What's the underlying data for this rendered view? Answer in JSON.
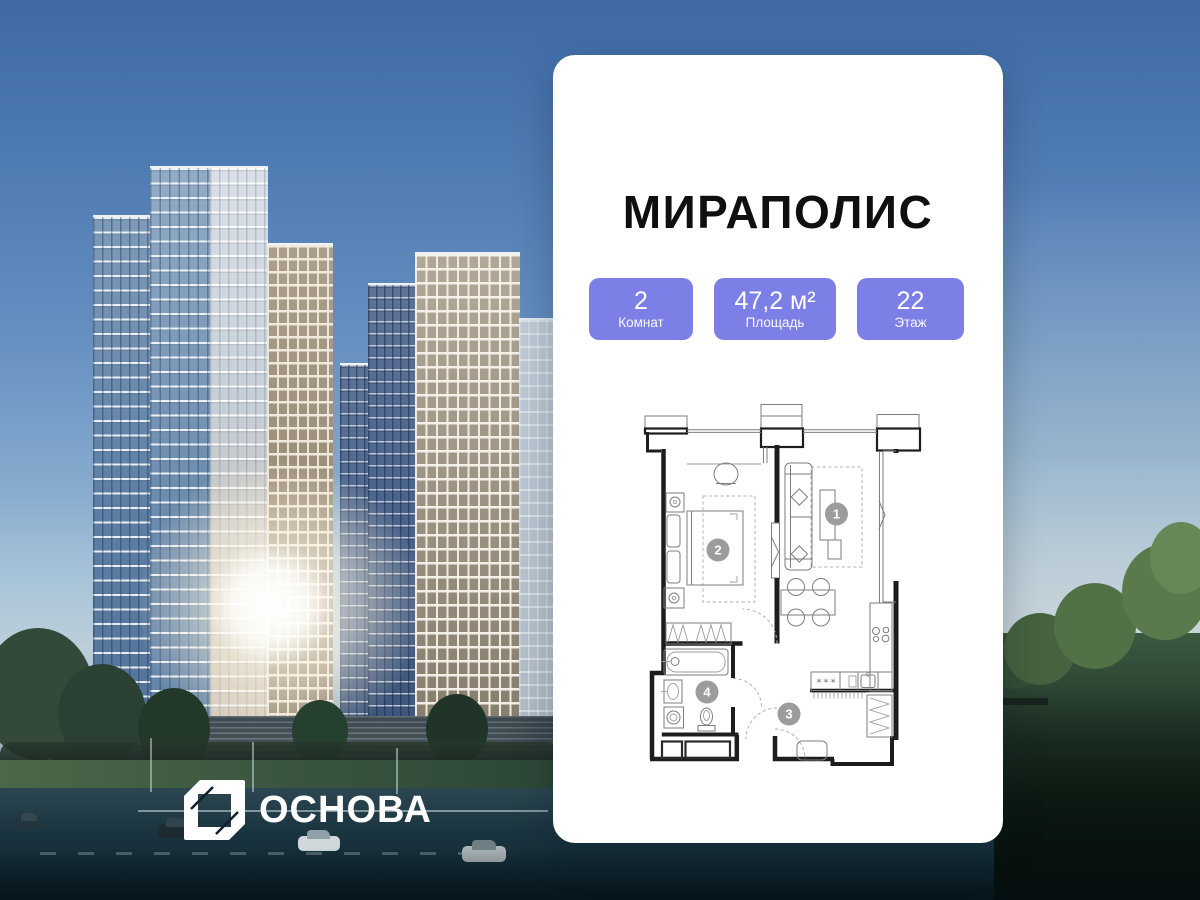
{
  "theme": {
    "badge_color": "#7c80e6",
    "card_color": "#ffffff",
    "title_color": "#0f0f0f",
    "logo_color": "#ffffff"
  },
  "card": {
    "title": "МИРАПОЛИС",
    "badges": [
      {
        "value": "2",
        "label": "Комнат"
      },
      {
        "value": "47,2 м²",
        "label": "Площадь"
      },
      {
        "value": "22",
        "label": "Этаж"
      }
    ],
    "floor_plan": {
      "room_labels": {
        "room1": "1",
        "room2": "2",
        "room3": "3",
        "room4": "4"
      },
      "counter_mark": "***"
    }
  },
  "developer_logo": {
    "text": "ОСНОВА"
  }
}
